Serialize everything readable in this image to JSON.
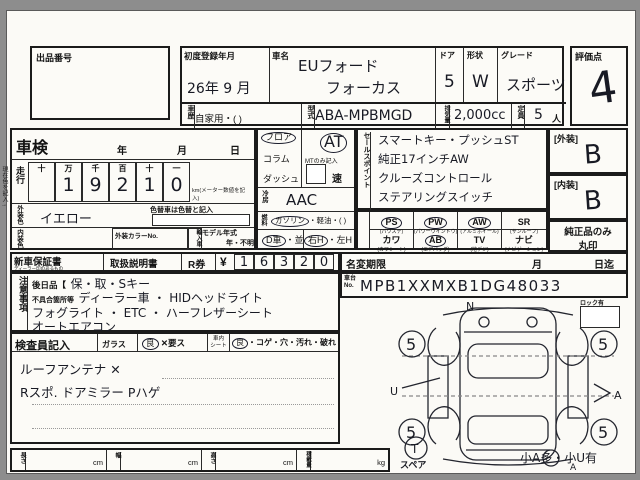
{
  "top": {
    "auction_no_label": "出品番号",
    "score_label": "評価点",
    "score_value": "4"
  },
  "header": {
    "first_reg_label": "初度登録年月",
    "first_reg_value": "26年 9 月",
    "car_name_label": "車名",
    "car_name_1": "EUフォード",
    "car_name_2": "フォーカス",
    "door_label": "ドア",
    "door_value": "5",
    "shape_label": "形状",
    "shape_value": "W",
    "grade_label": "グレード",
    "grade_value": "スポーツ",
    "history_label": "車歴",
    "history_value": "自家用・(        )",
    "model_label": "型式",
    "model_value": "ABA-MPBMGD",
    "disp_label": "排気量",
    "disp_value": "2,000cc",
    "cap_label": "定員",
    "cap_value": "5",
    "cap_unit": "人"
  },
  "left": {
    "shaken_label": "車検",
    "year": "年",
    "month": "月",
    "day": "日",
    "mileage_label": "走行",
    "digit_headers": [
      "十",
      "万",
      "千",
      "百",
      "十",
      "一"
    ],
    "digits": [
      "",
      "1",
      "9",
      "2",
      "1",
      "0"
    ],
    "km_note": "km(メーター数値を記入)",
    "ext_color_label": "外装色",
    "ext_color_value": "イエロー",
    "color_change_note": "色替車は色替と記入",
    "int_color_label": "内装色",
    "color_no_label": "外装カラーNo.",
    "import_label": "輸入車",
    "model_year_label": "モデル年式",
    "model_year_value": "年・不明",
    "current_color_note": "現在色を記入→"
  },
  "mid": {
    "shift_floor": "フロア",
    "floor_on": true,
    "shift_column": "コラム",
    "shift_dash": "ダッシュ",
    "at": "AT",
    "at_on": true,
    "mt_note": "MTのみ記入",
    "speed": "速",
    "ac_label": "冷房",
    "ac_value": "AAC",
    "fuel_label": "燃料",
    "fuel_gas": "ガソリン",
    "gas_on": true,
    "fuel_rest": "・軽油・(      )",
    "dealer": "D車",
    "dealer_on": true,
    "parallel": "・並",
    "rhd": "右H",
    "rhd_on": true,
    "lhd": "・左H"
  },
  "sales": {
    "label": "セールスポイント",
    "lines": [
      "スマートキー・プッシュST",
      "純正17インチAW",
      "クルーズコントロール",
      "ステアリングスイッチ"
    ]
  },
  "equip": {
    "items": [
      {
        "code": "PS",
        "sub": "(パワステ)",
        "on": true
      },
      {
        "code": "PW",
        "sub": "(パワーウインドウ)",
        "on": true
      },
      {
        "code": "AW",
        "sub": "(アルミホイール)",
        "on": true
      },
      {
        "code": "SR",
        "sub": "(サンルーフ)",
        "on": false
      },
      {
        "code": "カワ",
        "sub": "(カワシート)",
        "on": false
      },
      {
        "code": "AB",
        "sub": "(エアバッグ)",
        "on": true
      },
      {
        "code": "TV",
        "sub": "(地デジ)",
        "on": false
      },
      {
        "code": "ナビ",
        "sub": "(ナビゲーション)",
        "on": false
      }
    ]
  },
  "right": {
    "ext_label": "[外装]",
    "ext_grade": "B",
    "int_label": "[内装]",
    "int_grade": "B",
    "genuine_note1": "純正品のみ",
    "genuine_note2": "丸印"
  },
  "docs": {
    "warranty_label": "新車保証書",
    "warranty_sub": "ディーラー印のあるもの",
    "manual_label": "取扱説明書",
    "rticket_label": "R券",
    "yen": "¥",
    "price_digits": [
      "1",
      "6",
      "3",
      "2",
      "0"
    ]
  },
  "namechange": {
    "label": "名変期限",
    "month": "月",
    "day": "日迄"
  },
  "notes": {
    "label": "注意事項",
    "later_label": "後日品【",
    "later_value": "保・取・Sキー",
    "defect_label": "不具合箇所等",
    "defect_value": "ディーラー車 ・ HIDヘッドライト",
    "line3": "フォグライト ・ ETC ・ ハーフレザーシート",
    "line4": "オートエアコン"
  },
  "chassis": {
    "label1": "車台",
    "label2": "No.",
    "value": "MPB1XXMXB1DG48033"
  },
  "inspector": {
    "label": "検査員記入",
    "glass_label": "ガラス",
    "glass_good": "良",
    "glass_good_on": true,
    "glass_bad": "✕要ス",
    "seat_label1": "車内",
    "seat_label2": "シート",
    "seat_good": "良",
    "seat_good_on": true,
    "seat_opts": "・コゲ・穴・汚れ・破れ",
    "hand1": "ルーフアンテナ ✕",
    "hand2": "Rスポ. ドアミラー Pハゲ"
  },
  "diagram": {
    "lock_label": "ロック有",
    "tires": [
      "5",
      "5",
      "5",
      "5"
    ],
    "spare_mark": "T",
    "spare_label": "スペア",
    "mark_top": "N",
    "mark_left": "U",
    "mark_right": "A",
    "mark_bottom": "A",
    "summary": "小A多・小U有"
  },
  "bottom": {
    "length_label": "長さ",
    "width_label": "幅",
    "height_label": "高さ",
    "load_label": "積載量",
    "cm": "cm",
    "kg": "kg"
  }
}
